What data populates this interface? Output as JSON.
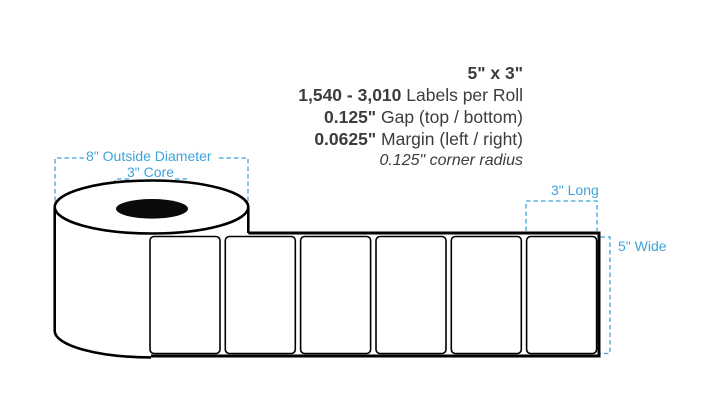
{
  "title": {
    "size": "5\" x 3\""
  },
  "specs": {
    "labels_per_roll": {
      "value": "1,540 - 3,010",
      "label": "Labels per Roll"
    },
    "gap": {
      "value": "0.125\"",
      "label": "Gap (top / bottom)"
    },
    "margin": {
      "value": "0.0625\"",
      "label": "Margin (left / right)"
    },
    "corner_radius": "0.125\" corner radius"
  },
  "annotations": {
    "outside_diameter": "8\" Outside Diameter",
    "core": "3\" Core",
    "length": "3\" Long",
    "width": "5\" Wide"
  },
  "diagram": {
    "label_count": 6,
    "colors": {
      "annotation_blue": "#3ea3db",
      "ink": "#3c3c3c",
      "outline": "#000000",
      "core_fill": "#0a0a0a",
      "background": "#ffffff"
    }
  }
}
